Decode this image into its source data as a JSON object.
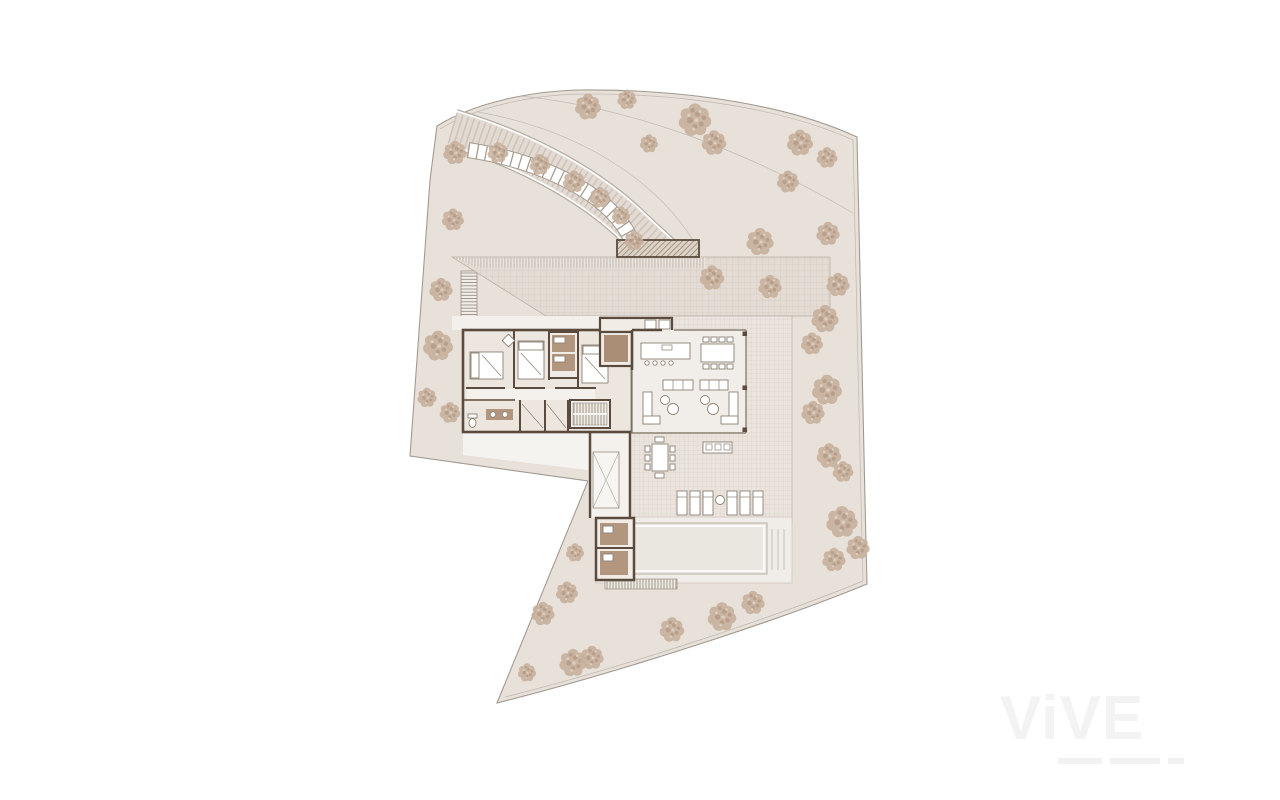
{
  "watermark": {
    "text": "ViVE"
  },
  "palette": {
    "site": "#e8e1da",
    "boundary": "#a29a90",
    "wall": "#5a4b3e",
    "wet_floor": "#b2967e",
    "entry_floor": "#ab8e76",
    "tree": "#c7b09c",
    "tree_dark": "#a68b74",
    "tree_light": "#e6d9cb",
    "forecourt": "#e4dcd4",
    "terrace": "#eae4dd",
    "pool": "#eae7e0"
  },
  "site": {
    "trees": [
      {
        "x": 588,
        "y": 106,
        "s": 1.0
      },
      {
        "x": 627,
        "y": 99,
        "s": 0.75
      },
      {
        "x": 649,
        "y": 143,
        "s": 0.7
      },
      {
        "x": 695,
        "y": 119,
        "s": 1.25
      },
      {
        "x": 714,
        "y": 142,
        "s": 0.95
      },
      {
        "x": 800,
        "y": 142,
        "s": 1.0
      },
      {
        "x": 827,
        "y": 157,
        "s": 0.8
      },
      {
        "x": 455,
        "y": 152,
        "s": 0.9
      },
      {
        "x": 498,
        "y": 152,
        "s": 0.8
      },
      {
        "x": 540,
        "y": 164,
        "s": 0.8
      },
      {
        "x": 574,
        "y": 181,
        "s": 0.85
      },
      {
        "x": 600,
        "y": 197,
        "s": 0.8
      },
      {
        "x": 621,
        "y": 215,
        "s": 0.7
      },
      {
        "x": 634,
        "y": 240,
        "s": 0.75
      },
      {
        "x": 453,
        "y": 219,
        "s": 0.85
      },
      {
        "x": 441,
        "y": 289,
        "s": 0.9
      },
      {
        "x": 438,
        "y": 345,
        "s": 1.15
      },
      {
        "x": 427,
        "y": 397,
        "s": 0.75
      },
      {
        "x": 450,
        "y": 412,
        "s": 0.8
      },
      {
        "x": 712,
        "y": 277,
        "s": 0.95
      },
      {
        "x": 760,
        "y": 241,
        "s": 1.05
      },
      {
        "x": 788,
        "y": 181,
        "s": 0.85
      },
      {
        "x": 770,
        "y": 286,
        "s": 0.9
      },
      {
        "x": 828,
        "y": 233,
        "s": 0.9
      },
      {
        "x": 838,
        "y": 284,
        "s": 0.9
      },
      {
        "x": 825,
        "y": 318,
        "s": 1.05
      },
      {
        "x": 812,
        "y": 343,
        "s": 0.85
      },
      {
        "x": 827,
        "y": 389,
        "s": 1.15
      },
      {
        "x": 813,
        "y": 412,
        "s": 0.9
      },
      {
        "x": 829,
        "y": 455,
        "s": 0.95
      },
      {
        "x": 843,
        "y": 471,
        "s": 0.8
      },
      {
        "x": 842,
        "y": 521,
        "s": 1.2
      },
      {
        "x": 858,
        "y": 547,
        "s": 0.9
      },
      {
        "x": 834,
        "y": 559,
        "s": 0.9
      },
      {
        "x": 575,
        "y": 552,
        "s": 0.7
      },
      {
        "x": 567,
        "y": 592,
        "s": 0.85
      },
      {
        "x": 543,
        "y": 613,
        "s": 0.9
      },
      {
        "x": 527,
        "y": 672,
        "s": 0.7
      },
      {
        "x": 573,
        "y": 662,
        "s": 1.05
      },
      {
        "x": 592,
        "y": 657,
        "s": 0.9
      },
      {
        "x": 672,
        "y": 629,
        "s": 0.95
      },
      {
        "x": 722,
        "y": 616,
        "s": 1.1
      },
      {
        "x": 753,
        "y": 602,
        "s": 0.9
      }
    ]
  }
}
